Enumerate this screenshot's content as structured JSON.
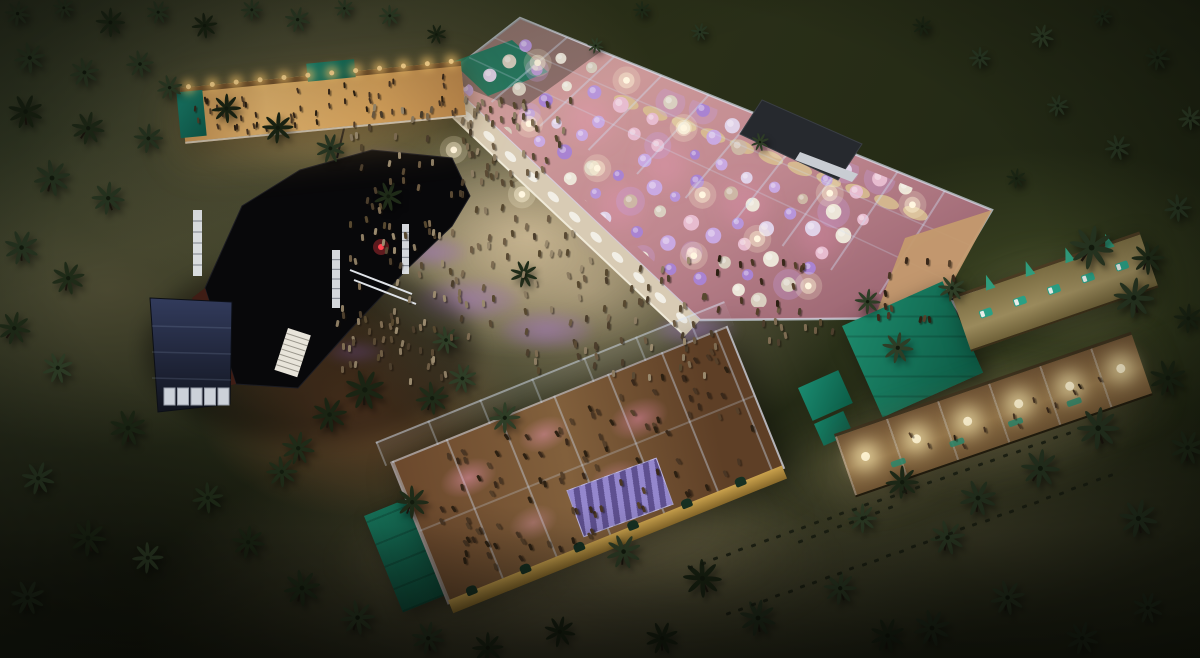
{
  "scene": {
    "description": "Night-time aerial 3D rendering of a beachside festival venue: black main stage, large glass-roofed dining pavilion with purple-lit round tables, bar tent with string lights, second glass party hall, lit pergola walkways, crowds and palm trees on sand and dark grass",
    "canvas": {
      "w": 1200,
      "h": 658
    },
    "palette": {
      "grass_dark": "#232915",
      "grass_light": "#556031",
      "sand": "#b5a68b",
      "sand_lit": "#cbb994",
      "terracotta": "#8a5434",
      "stage_black": "#08080a",
      "stage_wall_red": "#3f1d15",
      "truss_white": "#e6e9ee",
      "tent_navy": "#2b3452",
      "glass_frame": "#d0deF2",
      "floor_salmon": "#c08890",
      "table_purple": "#a983d2",
      "table_white": "#ece5d8",
      "canopy_cream": "#d9c191",
      "globe_warm": "#fff3d0",
      "string_light": "#ffd88f",
      "roof_teal": "#1d8a6c",
      "wall_yellow": "#caa24d",
      "purple_pool": "rgba(150,100,200,0.38)",
      "wood_fence": "#3c301d"
    }
  },
  "seed": 1337,
  "objects": {
    "mainPavilion": {
      "name": "main-dining-pavilion",
      "floorPoly": "443,78 520,18 992,210 928,318 700,320",
      "clipPoly": "462,90 524,32 978,214 918,304 706,308",
      "overhangPoly": "443,78 520,18 600,52 520,110",
      "greenPanelPoly": "452,62 512,40 548,72 488,96",
      "eastTerracePoly": "905,238 992,210 935,315 870,330",
      "topEdge": [
        [
          520,
          18
        ],
        [
          992,
          210
        ]
      ],
      "bottomEdge": [
        [
          443,
          78
        ],
        [
          928,
          318
        ]
      ],
      "trussCount": 10,
      "tables": {
        "cols": 14,
        "rows": 8,
        "u0": 18,
        "du": 31,
        "v0": 14,
        "dv": 26,
        "origin": [
          524,
          30
        ],
        "uDir": [
          0.933,
          0.358
        ],
        "vDir": [
          -0.789,
          0.615
        ],
        "skip": 0.1,
        "palette": [
          "#ece5d8",
          "#c9a9e2",
          "#a983d2",
          "#e7bccf",
          "#d9cfc0",
          "#b795da",
          "#e0d2e8",
          "#cdb7a5"
        ]
      },
      "canopies": {
        "uFrom": 140,
        "uTo": 452,
        "step": 31,
        "v": 36
      },
      "globes": [
        [
          40,
          30
        ],
        [
          120,
          12
        ],
        [
          205,
          40
        ],
        [
          290,
          18
        ],
        [
          370,
          50
        ],
        [
          440,
          28
        ],
        [
          90,
          100
        ],
        [
          180,
          120
        ],
        [
          280,
          105
        ],
        [
          360,
          130
        ],
        [
          150,
          180
        ],
        [
          330,
          175
        ],
        [
          440,
          160
        ],
        [
          60,
          160
        ]
      ],
      "pinkSpots": [
        [
          590,
          120
        ],
        [
          665,
          165
        ],
        [
          745,
          205
        ],
        [
          620,
          205
        ],
        [
          820,
          235
        ]
      ],
      "walkway": {
        "inner": [
          [
            443,
            78
          ],
          [
            700,
            320
          ]
        ],
        "outer": [
          [
            428,
            94
          ],
          [
            685,
            336
          ]
        ],
        "tables": 12
      }
    },
    "stage": {
      "name": "main-stage",
      "bodyPath": "M205,288 L242,206 L300,170 L372,150 L452,158 L470,196 L452,226 L408,268 L348,332 L298,388 L236,384 Z",
      "redWallPoly": "205,288 236,384 218,388 192,298",
      "trusses": [
        [
          193,
          210,
          9,
          66
        ],
        [
          332,
          250,
          8,
          58
        ],
        [
          402,
          224,
          7,
          50
        ]
      ],
      "stairs": [
        288,
        328,
        24,
        44
      ],
      "rails": [
        [
          350,
          270,
          412,
          294
        ],
        [
          354,
          280,
          416,
          304
        ]
      ],
      "redGlow": [
        381,
        247
      ],
      "pole": [
        337,
        158,
        346,
        120
      ]
    },
    "navyTent": {
      "name": "navy-marquee-tent",
      "poly": "150,298 232,302 230,404 158,412",
      "panels": {
        "x0": 164,
        "y": 388,
        "n": 5,
        "w": 11,
        "h": 17,
        "dx": 13.5
      }
    },
    "darkHut": {
      "name": "storage-hut",
      "poly": "762,100 862,144 838,180 740,134",
      "slatPoly": "800,152 858,174 852,182 795,160"
    },
    "gazebo": {
      "name": "white-roof-gazebo",
      "poly": "948,298 1014,280 1040,318 976,342",
      "center": [
        995,
        310
      ]
    },
    "barPavilion": {
      "name": "bar-pavilion",
      "x": 180,
      "y": 88,
      "w": 282,
      "h": 54,
      "rot": -5.5,
      "lights": 12
    },
    "bottomPavilion": {
      "name": "party-hall-pavilion",
      "x": 390,
      "y": 462,
      "w": 360,
      "h": 150,
      "rot": -22
    },
    "greenFlatRoof": {
      "name": "teal-flat-roof-annex",
      "x": 364,
      "y": 516,
      "w": 88,
      "h": 104,
      "rot": -22
    },
    "greenRoofRight": {
      "name": "teal-roof-building",
      "x": 842,
      "y": 326,
      "w": 110,
      "h": 100,
      "rot": -24
    },
    "tealBoxA": {
      "name": "teal-kiosk",
      "x": 798,
      "y": 388,
      "w": 44,
      "h": 36,
      "rot": -24
    },
    "tealBoxB": {
      "name": "teal-kiosk-small",
      "x": 814,
      "y": 424,
      "w": 32,
      "h": 24,
      "rot": -24
    },
    "rightWalkway": {
      "name": "pergola-walkway",
      "x": 834,
      "y": 434,
      "w": 314,
      "h": 62,
      "rot": -19,
      "globes": 6
    },
    "upperTerrace": {
      "name": "lounger-terrace",
      "x": 952,
      "y": 296,
      "w": 198,
      "h": 54,
      "rot": -19,
      "loungers": 5,
      "plants": 4
    }
  },
  "palms": [
    [
      18,
      14,
      0.7
    ],
    [
      64,
      8,
      0.6
    ],
    [
      110,
      22,
      0.8
    ],
    [
      158,
      12,
      0.65
    ],
    [
      205,
      26,
      0.7
    ],
    [
      252,
      10,
      0.6
    ],
    [
      298,
      20,
      0.7
    ],
    [
      344,
      8,
      0.55
    ],
    [
      390,
      16,
      0.6
    ],
    [
      436,
      34,
      0.55
    ],
    [
      596,
      46,
      0.45
    ],
    [
      642,
      10,
      0.5
    ],
    [
      700,
      32,
      0.5
    ],
    [
      922,
      26,
      0.55
    ],
    [
      980,
      58,
      0.6
    ],
    [
      1042,
      36,
      0.65
    ],
    [
      1102,
      16,
      0.55
    ],
    [
      1158,
      58,
      0.7
    ],
    [
      1190,
      118,
      0.65
    ],
    [
      1118,
      148,
      0.7
    ],
    [
      1058,
      106,
      0.6
    ],
    [
      1016,
      178,
      0.55
    ],
    [
      30,
      58,
      0.85
    ],
    [
      84,
      72,
      0.8
    ],
    [
      140,
      64,
      0.75
    ],
    [
      26,
      112,
      0.95
    ],
    [
      88,
      128,
      0.9
    ],
    [
      148,
      138,
      0.8
    ],
    [
      52,
      178,
      1
    ],
    [
      108,
      198,
      0.9
    ],
    [
      22,
      248,
      0.95
    ],
    [
      68,
      278,
      0.9
    ],
    [
      226,
      108,
      0.8
    ],
    [
      278,
      128,
      0.85
    ],
    [
      330,
      148,
      0.8
    ],
    [
      170,
      88,
      0.7
    ],
    [
      388,
      196,
      0.8
    ],
    [
      14,
      328,
      0.9
    ],
    [
      58,
      368,
      0.85
    ],
    [
      128,
      428,
      1
    ],
    [
      38,
      478,
      0.9
    ],
    [
      88,
      538,
      1
    ],
    [
      28,
      598,
      0.95
    ],
    [
      148,
      558,
      0.85
    ],
    [
      208,
      498,
      0.85
    ],
    [
      248,
      542,
      0.9
    ],
    [
      302,
      588,
      1
    ],
    [
      358,
      618,
      0.95
    ],
    [
      428,
      638,
      0.9
    ],
    [
      488,
      648,
      0.85
    ],
    [
      524,
      274,
      0.75
    ],
    [
      446,
      340,
      0.75
    ],
    [
      365,
      390,
      1.1
    ],
    [
      330,
      415,
      0.95
    ],
    [
      298,
      448,
      0.9
    ],
    [
      282,
      472,
      0.85
    ],
    [
      432,
      398,
      0.9
    ],
    [
      462,
      378,
      0.8
    ],
    [
      505,
      418,
      0.85
    ],
    [
      412,
      502,
      0.9
    ],
    [
      560,
      632,
      0.85
    ],
    [
      624,
      552,
      0.95
    ],
    [
      662,
      638,
      0.9
    ],
    [
      702,
      578,
      1.05
    ],
    [
      758,
      618,
      1
    ],
    [
      840,
      588,
      0.9
    ],
    [
      888,
      636,
      0.95
    ],
    [
      932,
      628,
      1
    ],
    [
      1008,
      598,
      0.95
    ],
    [
      1082,
      638,
      0.9
    ],
    [
      1148,
      608,
      0.85
    ],
    [
      1178,
      208,
      0.75
    ],
    [
      1148,
      258,
      0.9
    ],
    [
      1188,
      318,
      0.8
    ],
    [
      1092,
      248,
      1.2
    ],
    [
      1134,
      298,
      1.1
    ],
    [
      1168,
      378,
      1
    ],
    [
      1188,
      448,
      0.95
    ],
    [
      1098,
      428,
      1.15
    ],
    [
      1040,
      468,
      1.05
    ],
    [
      978,
      498,
      1
    ],
    [
      1138,
      518,
      1.05
    ],
    [
      898,
      348,
      0.85
    ],
    [
      952,
      288,
      0.75
    ],
    [
      868,
      302,
      0.7
    ],
    [
      902,
      482,
      0.9
    ],
    [
      948,
      538,
      0.95
    ],
    [
      862,
      518,
      0.8
    ],
    [
      760,
      142,
      0.5
    ]
  ],
  "crowdRegions": [
    {
      "name": "plaza-crowd-upper",
      "x": 350,
      "y": 100,
      "w": 170,
      "h": 110,
      "count": 55
    },
    {
      "name": "plaza-crowd-mid",
      "x": 345,
      "y": 215,
      "w": 230,
      "h": 160,
      "count": 95
    },
    {
      "name": "plaza-crowd-right",
      "x": 565,
      "y": 255,
      "w": 150,
      "h": 120,
      "count": 55
    },
    {
      "name": "plaza-crowd-top",
      "x": 455,
      "y": 95,
      "w": 115,
      "h": 85,
      "count": 35
    },
    {
      "name": "stage-front-crowd",
      "x": 330,
      "y": 300,
      "w": 120,
      "h": 85,
      "count": 22
    },
    {
      "name": "bar-guests",
      "parent": "barPavilion",
      "x": 8,
      "y": 10,
      "w": 264,
      "h": 40,
      "count": 50,
      "dark": true,
      "scale": 0.85
    },
    {
      "name": "party-hall-guests",
      "parent": "bottomPavilion",
      "x": 15,
      "y": 10,
      "w": 330,
      "h": 130,
      "count": 105,
      "dark": true
    },
    {
      "name": "east-terrace-guests",
      "x": 872,
      "y": 255,
      "w": 90,
      "h": 62,
      "count": 13,
      "dark": true
    },
    {
      "name": "walkway-guests",
      "parent": "rightWalkway",
      "x": 30,
      "y": 16,
      "w": 250,
      "h": 34,
      "count": 13,
      "dark": true,
      "scale": 0.9
    },
    {
      "name": "path-guests",
      "x": 760,
      "y": 300,
      "w": 90,
      "h": 60,
      "count": 12
    },
    {
      "name": "pavilion-edge-guests",
      "x": 700,
      "y": 250,
      "w": 110,
      "h": 60,
      "count": 14,
      "dark": true
    }
  ],
  "purplePools": [
    [
      382,
      168,
      56,
      24
    ],
    [
      432,
      252,
      48,
      20
    ],
    [
      468,
      300,
      72,
      28
    ],
    [
      546,
      330,
      64,
      26
    ],
    [
      614,
      238,
      44,
      18
    ],
    [
      658,
      122,
      38,
      16
    ],
    [
      696,
      330,
      56,
      22
    ],
    [
      562,
      182,
      36,
      16
    ],
    [
      636,
      390,
      60,
      24
    ],
    [
      608,
      432,
      48,
      20
    ],
    [
      520,
      120,
      30,
      14
    ],
    [
      688,
      210,
      34,
      15
    ],
    [
      648,
      470,
      54,
      22
    ],
    [
      600,
      500,
      44,
      18
    ],
    [
      355,
      352,
      40,
      14
    ]
  ],
  "glowPools": [
    [
      520,
      255,
      230,
      130,
      "rgba(244,214,168,0.20)"
    ],
    [
      318,
      126,
      170,
      70,
      "rgba(255,202,120,0.30)"
    ],
    [
      992,
      420,
      200,
      95,
      "rgba(255,232,168,0.25)"
    ],
    [
      1062,
      298,
      140,
      70,
      "rgba(255,232,176,0.20)"
    ],
    [
      600,
      520,
      280,
      120,
      "rgba(250,214,160,0.15)"
    ],
    [
      688,
      562,
      200,
      90,
      "rgba(235,210,150,0.13)"
    ],
    [
      450,
      562,
      160,
      80,
      "rgba(240,205,150,0.12)"
    ],
    [
      860,
      470,
      120,
      60,
      "rgba(255,225,160,0.18)"
    ]
  ],
  "trails": [
    {
      "x1": 688,
      "y1": 566,
      "x2": 1066,
      "y2": 432
    },
    {
      "x1": 726,
      "y1": 612,
      "x2": 1108,
      "y2": 474
    },
    {
      "x1": 798,
      "y1": 540,
      "x2": 888,
      "y2": 506
    }
  ]
}
